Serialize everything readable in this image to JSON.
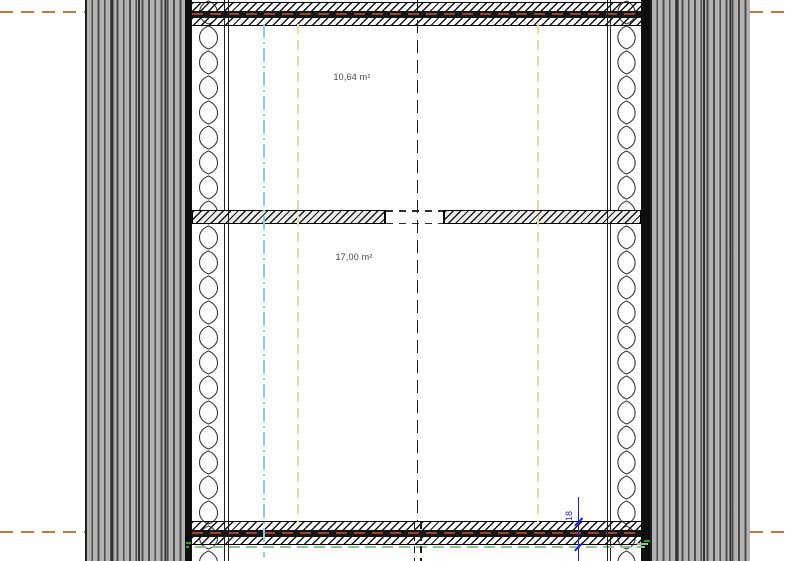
{
  "drawing": {
    "type": "architectural-floor-plan-section",
    "rooms": [
      {
        "area_label": "10,64 m²"
      },
      {
        "area_label": "17,00 m²"
      }
    ],
    "dimensions": {
      "upper_label": "18",
      "lower_label": "18"
    },
    "colors": {
      "cladding_gray": "#b3b3b3",
      "reference_line_orange": "#bf7b42",
      "band_center_line_brown": "#9c4230",
      "axis_cyan": "#8ecdd6",
      "axis_pale_yellow": "#e6dca6",
      "finish_line_green": "#8cc88c",
      "dimension_blue": "#2323cc"
    }
  }
}
